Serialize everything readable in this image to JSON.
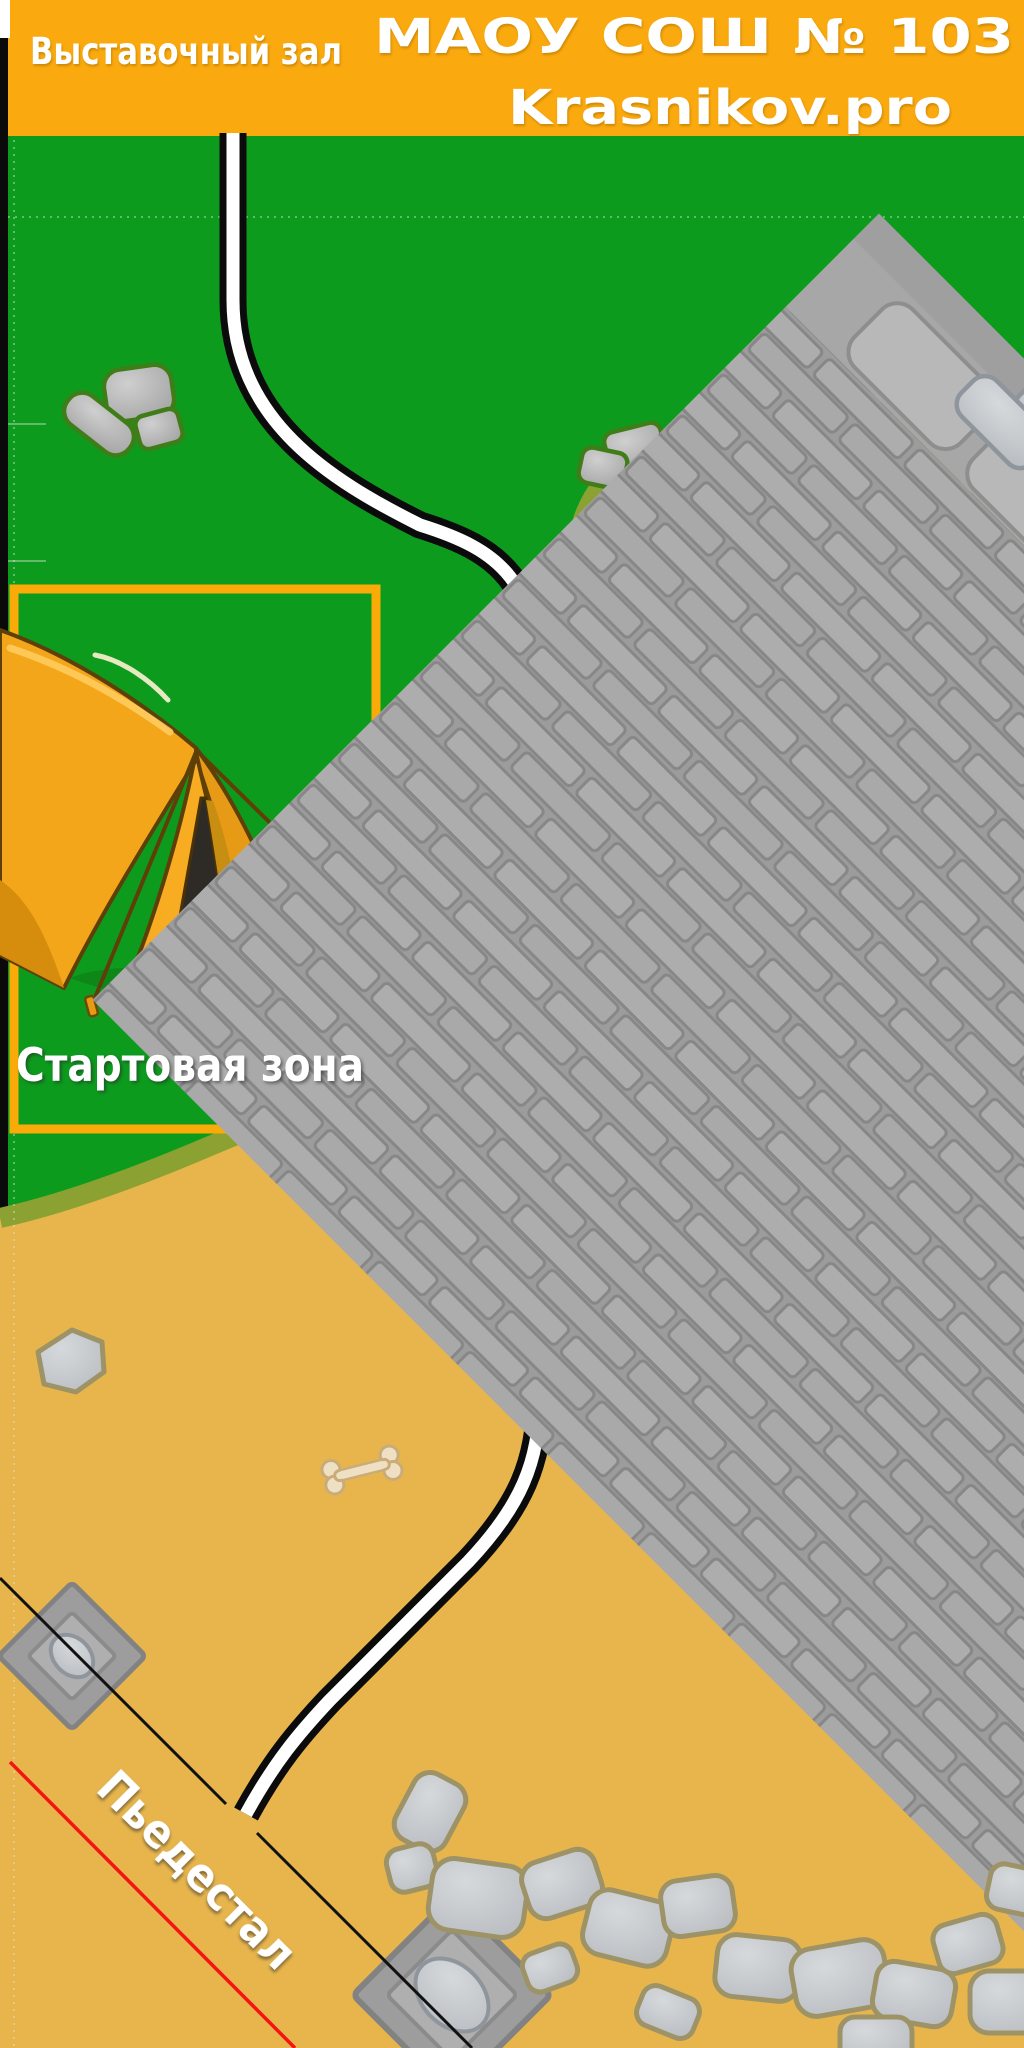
{
  "header": {
    "left_title": "Выставочный зал",
    "school_title": "МАОУ СОШ № 103",
    "site": "Krasnikov.pro"
  },
  "map": {
    "start_zone_label": "Стартовая зона",
    "pedestal_label": "Пьедестал",
    "objects": [
      "tent-icon",
      "rock-icon",
      "bone-icon",
      "road-path",
      "pedestal-platform"
    ],
    "colors": {
      "header_orange": "#FAA90E",
      "zone_border_orange": "#FBAB07",
      "grass_green": "#0D9B1E",
      "sand": "#E7B54C",
      "sand_border_olive": "#8BA233",
      "road_black": "#0B0B0B",
      "road_white": "#FFFFFF",
      "pedestal_gray": "#A7A7A7",
      "finish_line_red": "#F31414",
      "tent_orange": "#F4A61B"
    }
  }
}
